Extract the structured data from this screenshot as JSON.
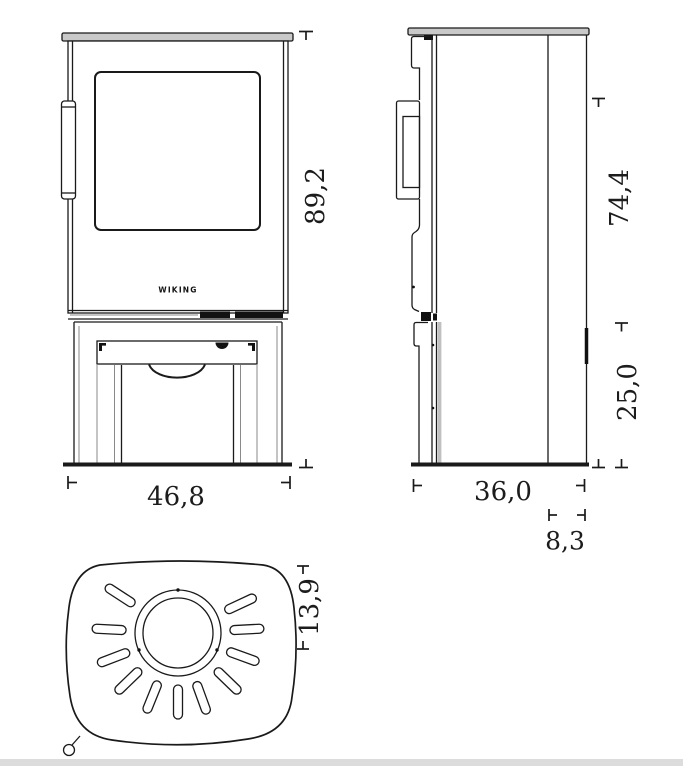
{
  "logo": "WIKING",
  "dimensions": {
    "front_height": "89,2",
    "front_width": "46,8",
    "side_upper_height": "74,4",
    "side_lower_height": "25,0",
    "side_depth": "36,0",
    "side_flue_offset": "8,3",
    "top_flue_offset": "13,9"
  },
  "colors": {
    "line": "#1a1a1a",
    "plate_fill": "#c9c9c9",
    "dimension_text": "#1c1c1c",
    "background": "#ffffff"
  }
}
